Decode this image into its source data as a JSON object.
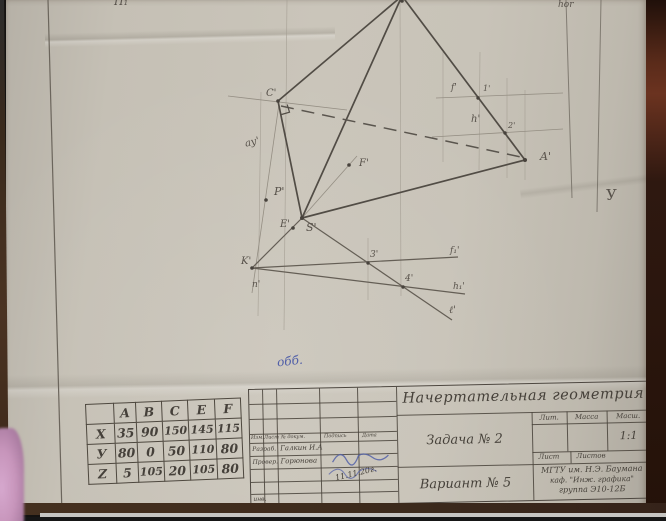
{
  "colors": {
    "paper": "#c8c3b8",
    "pencil": "#55504a",
    "ink_blue": "#5260a8",
    "pink": "#c795bb",
    "table_brown": "#36220f"
  },
  "sheet": {
    "corner_label": "П₁",
    "top_right_label": "hor",
    "axis_label": "У",
    "grader_mark": "обб."
  },
  "drawing": {
    "labels": {
      "C": "C'",
      "A": "A'",
      "S": "S'",
      "E": "E'",
      "F": "F'",
      "P": "P'",
      "K": "K'",
      "n": "n'",
      "au": "ау'",
      "f": "f'",
      "p1": "1'",
      "h": "h'",
      "p2": "2'",
      "p3": "3'",
      "p4": "4'",
      "f1": "f₁'",
      "h1": "h₁'",
      "l": "ℓ'"
    }
  },
  "coords_table": {
    "col_headers": [
      "A",
      "B",
      "C",
      "E",
      "F"
    ],
    "rows": [
      {
        "name": "X",
        "values": [
          "35",
          "90",
          "150",
          "145",
          "115"
        ]
      },
      {
        "name": "У",
        "values": [
          "80",
          "0",
          "50",
          "110",
          "80"
        ]
      },
      {
        "name": "Z",
        "values": [
          "5",
          "105",
          "20",
          "105",
          "80"
        ]
      }
    ]
  },
  "stamp": {
    "title": "Начертательная геометрия",
    "task": "Задача № 2",
    "variant": "Вариант № 5",
    "lit_label": "Лит.",
    "mass_label": "Масса",
    "scale_label": "Масш.",
    "scale_value": "1:1",
    "sheet_label": "Лист",
    "sheets_label": "Листов",
    "org_line1": "МГТУ им. Н.Э. Баумана",
    "org_line2": "каф. \"Инж. графика\"",
    "org_line3": "группа Э10-12Б",
    "header_cols": [
      "Изм.",
      "Лист",
      "№ докум.",
      "Подпись",
      "Дата"
    ],
    "row1_label": "Разраб.",
    "row1_value": "Галкин И.А",
    "row2_label": "Провер.",
    "row2_value": "Горюнова",
    "corner_note": "инв.",
    "signature_date": "11.11.20г."
  }
}
